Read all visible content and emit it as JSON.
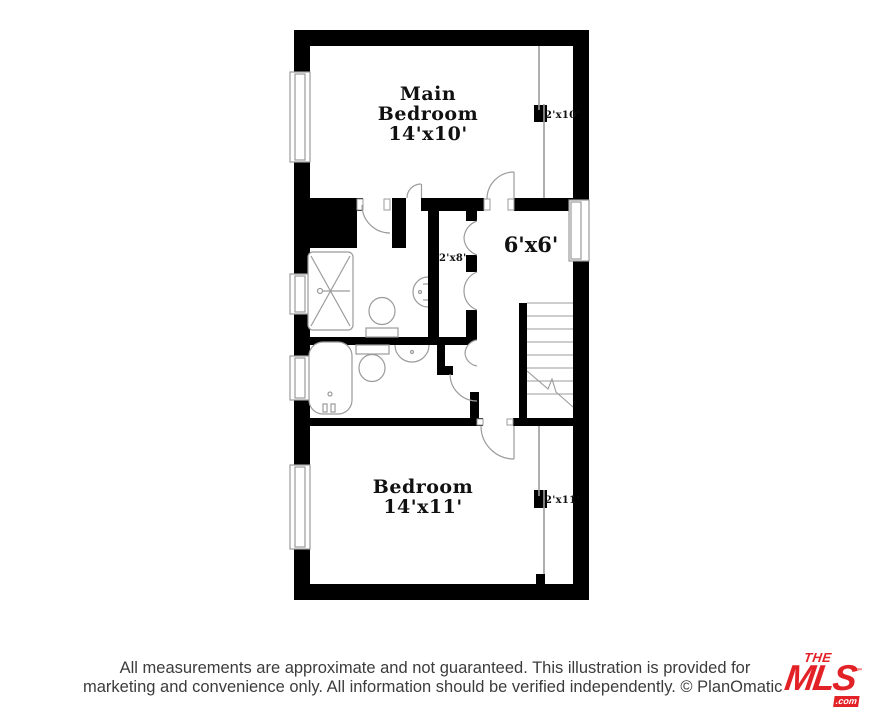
{
  "floor_plan": {
    "main_bedroom": {
      "name": "Main Bedroom",
      "dims": "14'x10'"
    },
    "bedroom": {
      "name": "Bedroom",
      "dims": "14'x11'"
    },
    "landing": {
      "dims": "6'x6'"
    },
    "closet_main_bedroom": {
      "dims": "2'x10'"
    },
    "closet_hall": {
      "dims": "2'x8'"
    },
    "closet_bedroom": {
      "dims": "2'x11'"
    },
    "features": [
      "shower",
      "bathtub",
      "toilets",
      "sinks",
      "stairs",
      "windows",
      "bifold-doors",
      "sliding-doors",
      "door-swings"
    ]
  },
  "footer": {
    "disclaimer_line1": "All measurements are approximate and not guaranteed. This illustration is provided for",
    "disclaimer_line2": "marketing and convenience only. All information should be verified independently. © PlanOmatic.",
    "logo": {
      "line1": "THE",
      "line2": "MLS",
      "tm": "™",
      "tld": ".com"
    }
  },
  "colors": {
    "background": "#ffffff",
    "walls": "#000000",
    "fixtures": "#9b9b9b",
    "labels": "#111111",
    "disclaimer_text": "#3c3c3c",
    "logo_red": "#e32227"
  }
}
